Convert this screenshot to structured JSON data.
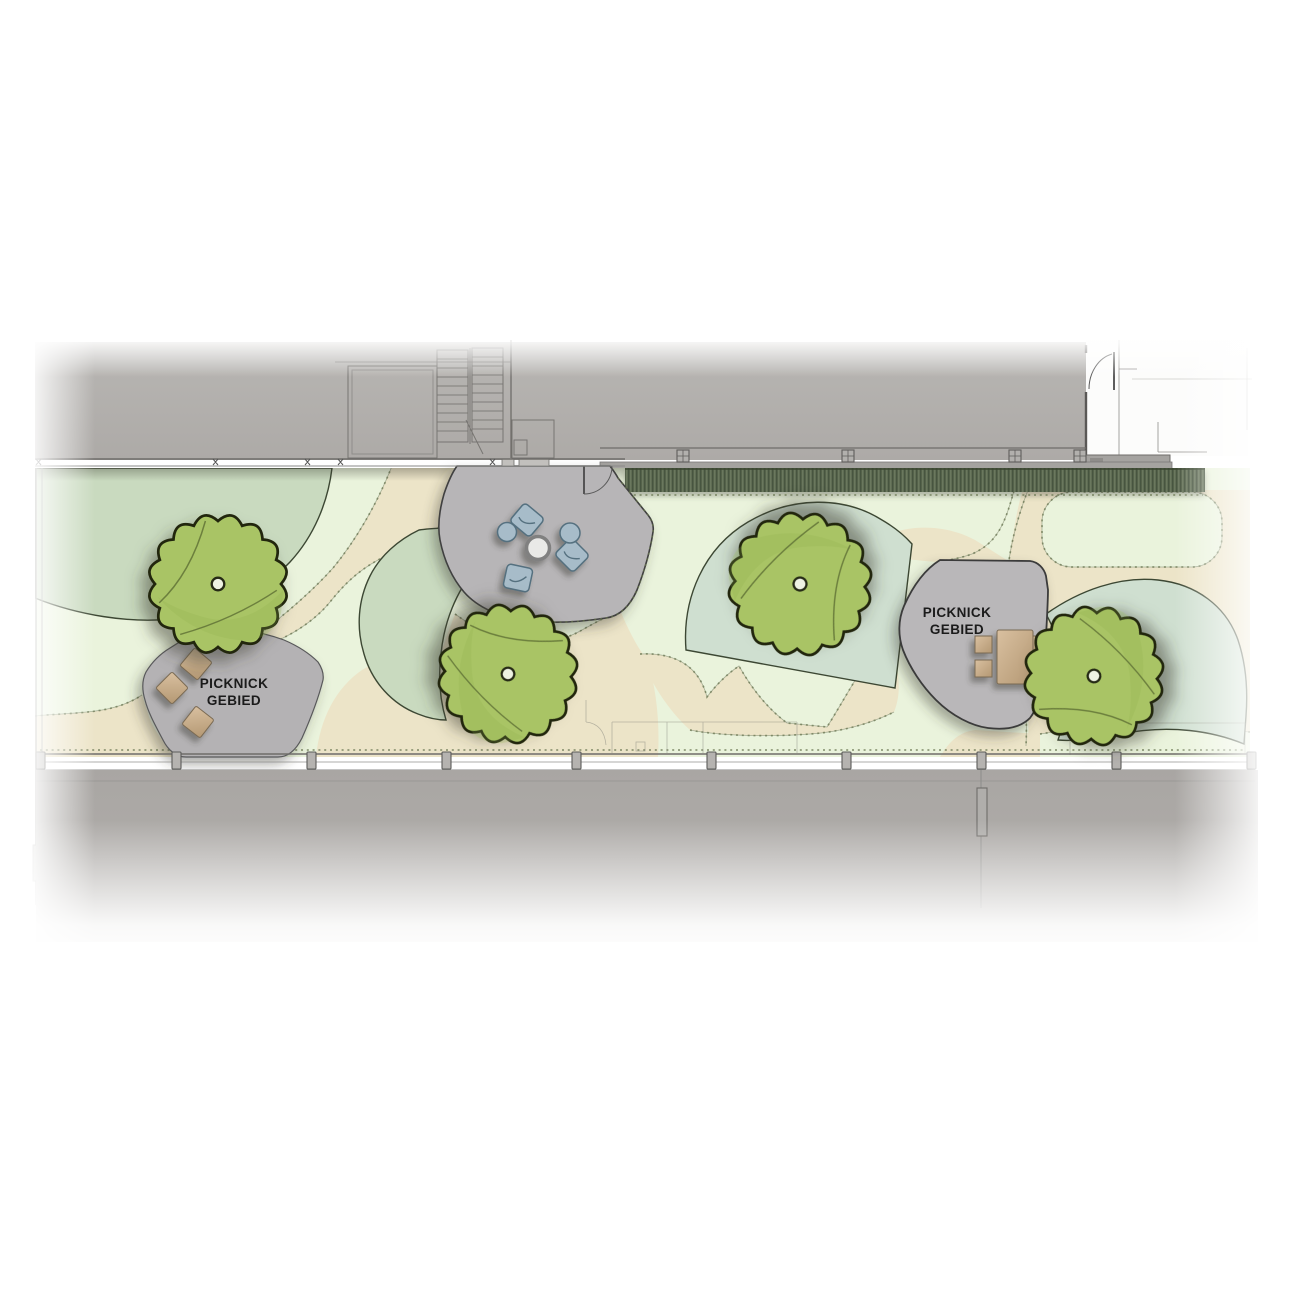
{
  "plan": {
    "type": "landscape-site-plan",
    "labels": [
      {
        "id": "picnic-area-west",
        "line1": "PICKNICK",
        "line2": "GEBIED"
      },
      {
        "id": "picnic-area-east",
        "line1": "PICKNICK",
        "line2": "GEBIED"
      }
    ],
    "colors": {
      "lawn": "#eaf3dc",
      "path_tan": "#ece4c8",
      "planting_sage": "#c9dabf",
      "planting_sage_light": "#cfdfd0",
      "hedge_green": "#5e6c53",
      "tree_canopy": "#a9c465",
      "plaza_gray": "#b7b5b7",
      "building_gray": "#b3b1ae",
      "terrace_gray": "#a9a6a3",
      "furniture_blue": "#a7bcc9",
      "wood_tan": "#c9ad8a"
    },
    "counts": {
      "trees": 4,
      "seat_cubes": 3,
      "lounge_poufs": 3,
      "round_poufs": 2,
      "round_tables": 1,
      "picnic_tables": 1
    }
  }
}
